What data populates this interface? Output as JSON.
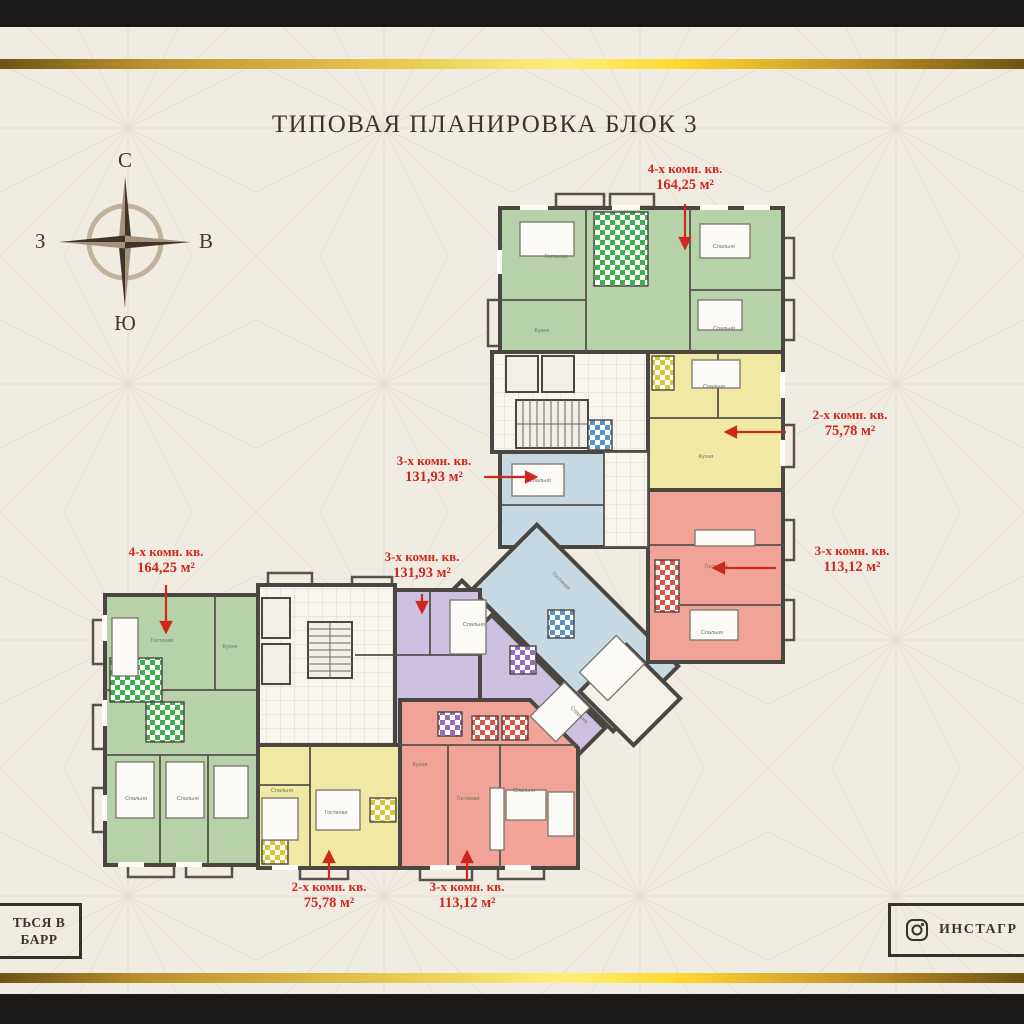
{
  "title": "ТИПОВАЯ ПЛАНИРОВКА БЛОК 3",
  "compass": {
    "north": "С",
    "south": "Ю",
    "west": "З",
    "east": "В"
  },
  "apartment_labels": [
    {
      "line1": "4-х комн. кв.",
      "line2": "164,25 м²"
    },
    {
      "line1": "2-х комн. кв.",
      "line2": "75,78 м²"
    },
    {
      "line1": "3-х комн. кв.",
      "line2": "113,12 м²"
    },
    {
      "line1": "3-х комн. кв.",
      "line2": "131,93 м²"
    },
    {
      "line1": "4-х комн. кв.",
      "line2": "164,25 м²"
    },
    {
      "line1": "3-х комн. кв.",
      "line2": "131,93 м²"
    },
    {
      "line1": "2-х комн. кв.",
      "line2": "75,78 м²"
    },
    {
      "line1": "3-х комн. кв.",
      "line2": "113,12 м²"
    }
  ],
  "room_labels": [
    "Гостиная",
    "Спальня",
    "Спальня",
    "Кухня",
    "Спальня",
    "Кухня",
    "Спальня",
    "Гостиная",
    "Спальня",
    "Гостиная",
    "Спальня",
    "Гостиная",
    "Кухня",
    "Спальня",
    "Спальня",
    "Спальня",
    "Гостиная",
    "Кухня",
    "Гостиная",
    "Спальня",
    "Спальня"
  ],
  "footer": {
    "left_line1": "ТЬСЯ В",
    "left_line2": "БАРР",
    "right_text": "ИНСТАГР"
  },
  "colors": {
    "green": "#b7d2a8",
    "yellow": "#efe9a4",
    "blue": "#c6d9e2",
    "purple": "#cdc0e0",
    "red": "#f0a396",
    "tile": "#f8f5ef",
    "wall": "#4a4743",
    "label_red": "#ce271c",
    "gold": "#e7c84f",
    "background": "#f1ece2"
  }
}
